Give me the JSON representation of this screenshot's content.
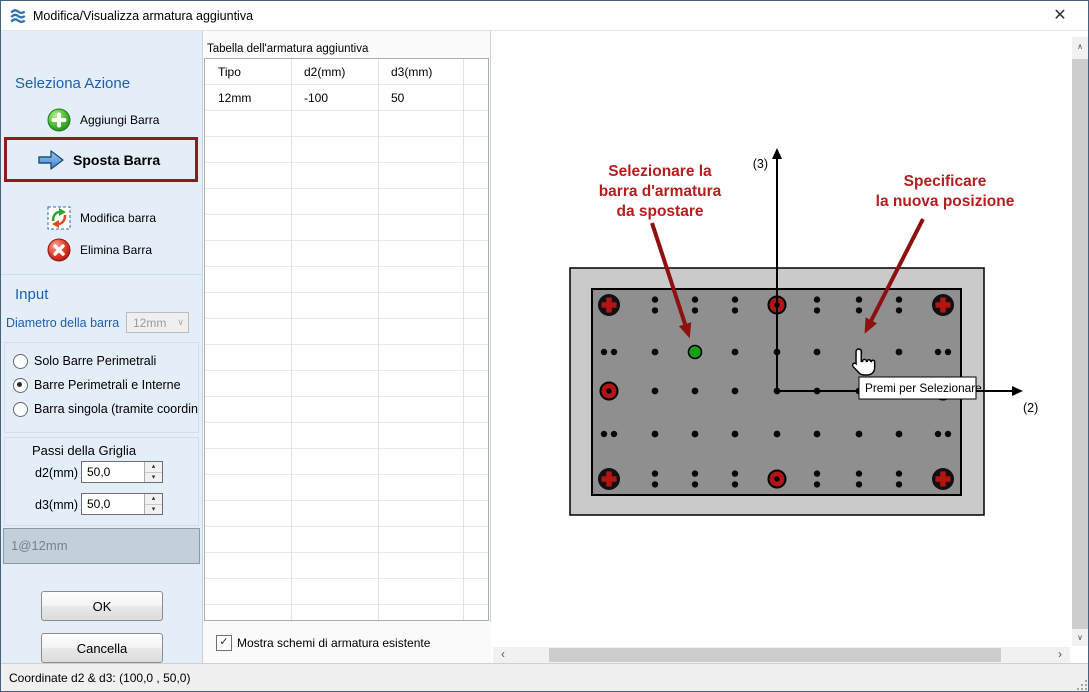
{
  "window": {
    "title": "Modifica/Visualizza armatura aggiuntiva"
  },
  "icons": {
    "close": "✕",
    "check": "✓",
    "dropdown_chevron": "∨",
    "spin_up": "▴",
    "spin_down": "▾",
    "scroll_left": "‹",
    "scroll_right": "›",
    "scroll_up": "∧",
    "scroll_down": "∨"
  },
  "colors": {
    "heading_blue": "#1D5FAE",
    "selection_border": "#8A1D1D",
    "annotation_red": "#B41E1E",
    "arrow_red": "#8F1010",
    "bar_green": "#17A017",
    "rebar_red": "#B51414",
    "sidebar_bg": "#E4EEF9"
  },
  "sidebar": {
    "heading": "Seleziona Azione",
    "actions": [
      {
        "label": "Aggiungi Barra"
      },
      {
        "label": "Sposta Barra"
      },
      {
        "label": "Modifica barra"
      },
      {
        "label": "Elimina Barra"
      }
    ],
    "input_heading": "Input",
    "diameter_label": "Diametro della barra",
    "diameter_value": "12mm",
    "radio_options": [
      {
        "label": "Solo Barre Perimetrali",
        "selected": false
      },
      {
        "label": "Barre Perimetrali e Interne",
        "selected": true
      },
      {
        "label": "Barra singola (tramite coordinate",
        "selected": false
      }
    ],
    "grid_box": {
      "title": "Passi della Griglia",
      "d2_label": "d2(mm)",
      "d2_value": "50,0",
      "d3_label": "d3(mm)",
      "d3_value": "50,0"
    },
    "summary": "1@12mm",
    "ok_label": "OK",
    "cancel_label": "Cancella"
  },
  "table_panel": {
    "title": "Tabella dell'armatura aggiuntiva",
    "columns": [
      "Tipo",
      "d2(mm)",
      "d3(mm)"
    ],
    "rows": [
      [
        "12mm",
        "-100",
        "50"
      ]
    ],
    "checkbox_label": "Mostra schemi di armatura esistente",
    "checkbox_checked": true
  },
  "canvas": {
    "select_note": [
      "Selezionare la",
      "barra d'armatura",
      "da spostare"
    ],
    "specify_note": [
      "Specificare",
      "la nuova posizione"
    ],
    "axis_labels": {
      "vertical": "(3)",
      "horizontal": "(2)"
    },
    "tooltip": "Premi per Selezionare",
    "drawing": {
      "grid_x": [
        117,
        163,
        203,
        243,
        285,
        325,
        367,
        407,
        451
      ],
      "grid_y": [
        274,
        321,
        360,
        403,
        448
      ],
      "selected_bar": {
        "row": 1,
        "col": 2
      }
    }
  },
  "statusbar": {
    "text": "Coordinate d2 & d3: (100,0 , 50,0)"
  }
}
